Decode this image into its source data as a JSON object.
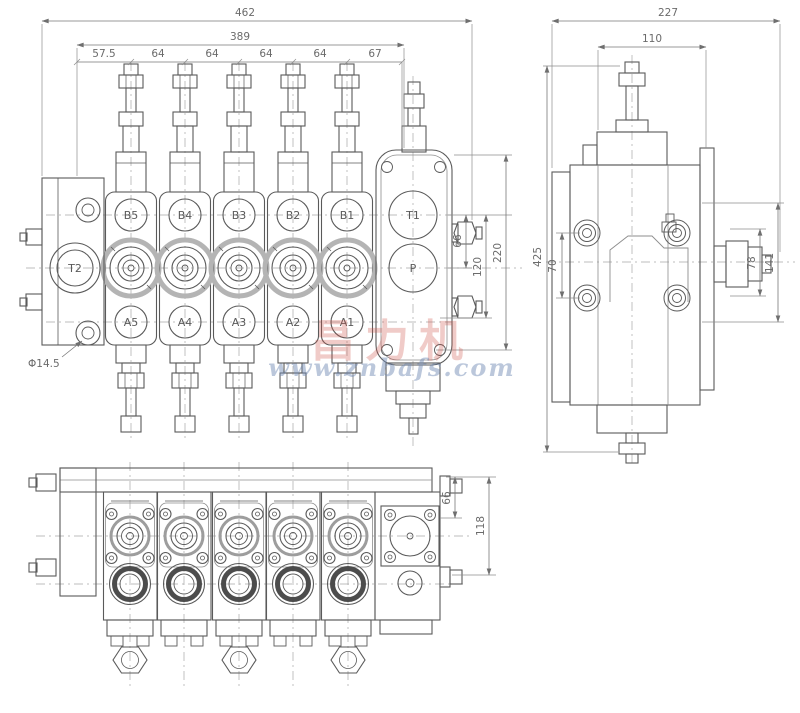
{
  "front_view": {
    "dims_top": {
      "overall": "462",
      "inner": "389",
      "segments": [
        "57.5",
        "64",
        "64",
        "64",
        "64",
        "67"
      ]
    },
    "dims_right": [
      "66",
      "120",
      "220"
    ],
    "hole_label": "Φ14.5",
    "ports_top": [
      "B5",
      "B4",
      "B3",
      "B2",
      "B1"
    ],
    "ports_bottom": [
      "A5",
      "A4",
      "A3",
      "A2",
      "A1"
    ],
    "port_left": "T2",
    "port_inlet_top": "T1",
    "port_inlet_mid": "P"
  },
  "side_view": {
    "dim_overall_width": "227",
    "dim_inner_width": "110",
    "dim_overall_height": "425",
    "dim_bolt_spacing": "70",
    "dim_relief_width": "78",
    "dim_relief_length": "141"
  },
  "bottom_view": {
    "dim_inner": "66",
    "dim_overall": "118"
  },
  "watermark": {
    "cn": "昌力机",
    "url": "www.znbafs.com",
    "red": "#ce5448",
    "blue": "#708ab4"
  }
}
